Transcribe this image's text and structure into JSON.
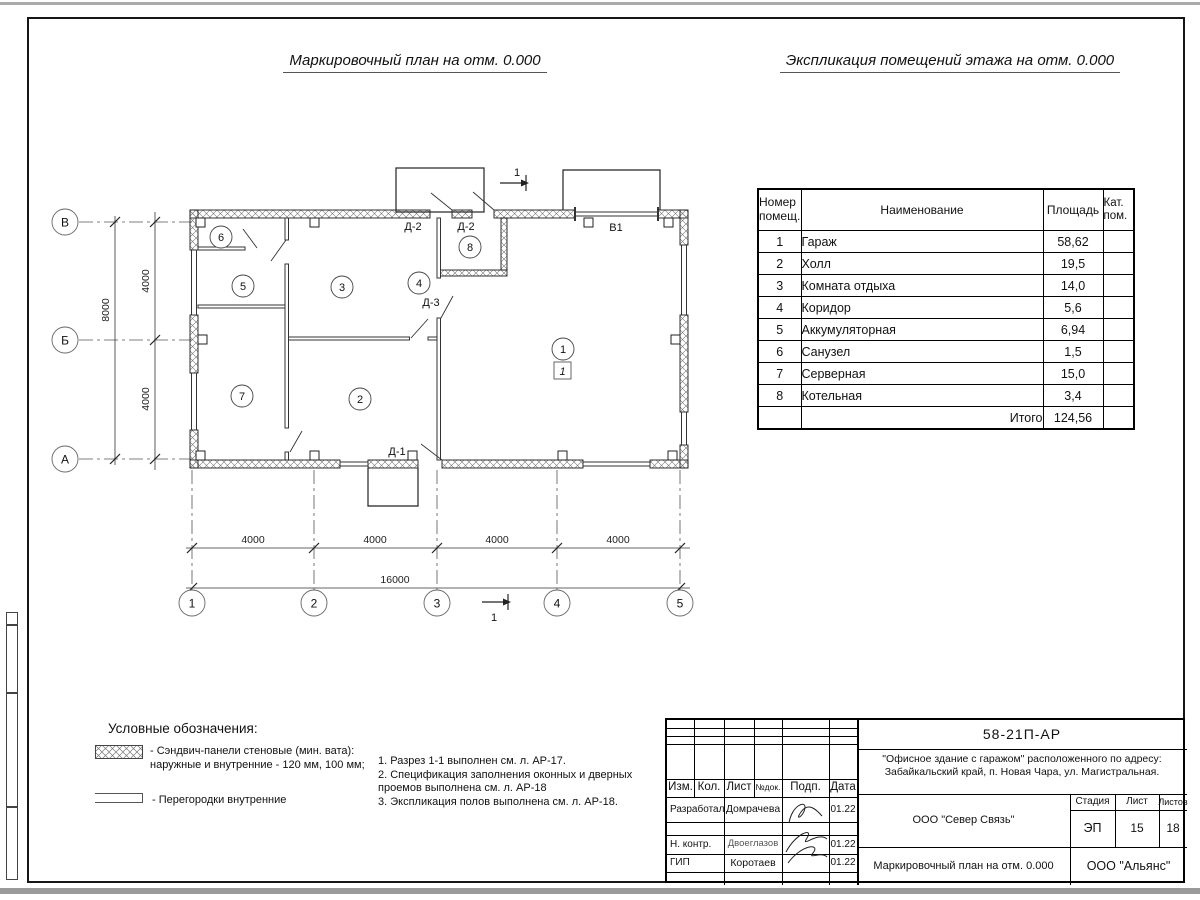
{
  "titles": {
    "plan": "Маркировочный план на отм. 0.000",
    "explication": "Экспликация помещений этажа на отм. 0.000"
  },
  "room_table": {
    "col_num": "Номер помещ.",
    "col_name": "Наименование",
    "col_area": "Площадь",
    "col_cat": "Кат. пом.",
    "rows": [
      {
        "num": "1",
        "name": "Гараж",
        "area": "58,62"
      },
      {
        "num": "2",
        "name": "Холл",
        "area": "19,5"
      },
      {
        "num": "3",
        "name": "Комната отдыха",
        "area": "14,0"
      },
      {
        "num": "4",
        "name": "Коридор",
        "area": "5,6"
      },
      {
        "num": "5",
        "name": "Аккумуляторная",
        "area": "6,94"
      },
      {
        "num": "6",
        "name": "Санузел",
        "area": "1,5"
      },
      {
        "num": "7",
        "name": "Серверная",
        "area": "15,0"
      },
      {
        "num": "8",
        "name": "Котельная",
        "area": "3,4"
      }
    ],
    "total_label": "Итого",
    "total_value": "124,56"
  },
  "plan": {
    "grid_rows": [
      "В",
      "Б",
      "А"
    ],
    "grid_cols": [
      "1",
      "2",
      "3",
      "4",
      "5"
    ],
    "dims": {
      "v1": "4000",
      "v2": "4000",
      "v_total": "8000",
      "h1": "4000",
      "h2": "4000",
      "h3": "4000",
      "h4": "4000",
      "h_total": "16000"
    },
    "rooms": [
      "1",
      "2",
      "3",
      "4",
      "5",
      "6",
      "7",
      "8"
    ],
    "floor_mark": "1",
    "doors": {
      "d1": "Д-1",
      "d2a": "Д-2",
      "d2b": "Д-2",
      "d3": "Д-3",
      "gate": "В1"
    },
    "section": "1"
  },
  "legend": {
    "heading": "Условные обозначения:",
    "item1_line1": "- Сэндвич-панели стеновые (мин. вата):",
    "item1_line2": "наружные и внутренние - 120 мм, 100 мм;",
    "item2": "- Перегородки внутренние"
  },
  "notes": {
    "line1": "1. Разрез 1-1 выполнен см. л. АР-17.",
    "line2": "2. Спецификация заполнения оконных и дверных",
    "line3": "проемов выполнена см. л. АР-18",
    "line4": "3. Экспликация полов выполнена см. л. АР-18."
  },
  "stamp": {
    "doc_number": "58-21П-АР",
    "object_line1": "\"Офисное здание с гаражом\" расположенного по адресу:",
    "object_line2": "Забайкальский край, п. Новая Чара, ул. Магистральная.",
    "header": {
      "izm": "Изм.",
      "kol": "Кол.",
      "list": "Лист",
      "ndok": "№док.",
      "podp": "Подп.",
      "data": "Дата"
    },
    "roles": {
      "developed_label": "Разработал",
      "developed_name": "Домрачева",
      "developed_date": "01.22",
      "ncontr_label": "Н. контр.",
      "ncontr_name": "Двоеглазов",
      "ncontr_date": "01.22",
      "gip_label": "ГИП",
      "gip_name": "Коротаев",
      "gip_date": "01.22"
    },
    "org": "ООО \"Север Связь\"",
    "stage_label": "Стадия",
    "sheet_label": "Лист",
    "sheets_label": "Листов",
    "stage": "ЭП",
    "sheet": "15",
    "sheets": "18",
    "sheet_title": "Маркировочный план на отм. 0.000",
    "org2": "ООО \"Альянс\""
  }
}
